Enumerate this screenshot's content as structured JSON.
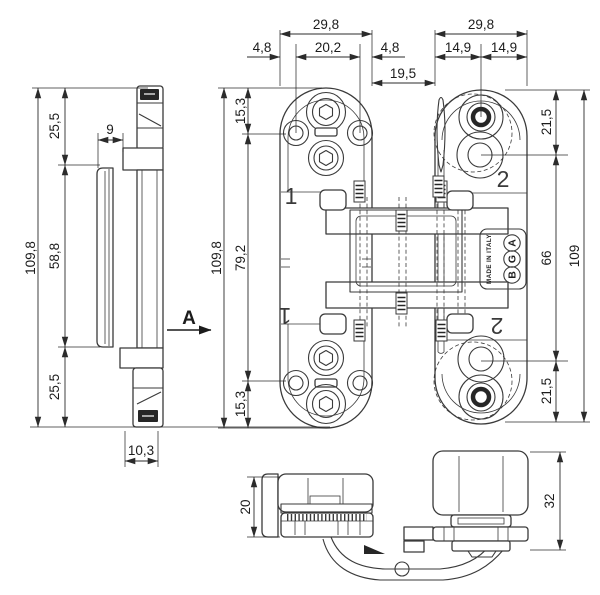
{
  "drawing": {
    "type": "technical-drawing",
    "subject": "concealed hinge dimensioned views",
    "colors": {
      "line": "#3a3a3a",
      "dimension": "#2b2b2b",
      "text": "#1c1c1c",
      "dark_fill": "#262626",
      "background": "#ffffff"
    },
    "section_label": "A",
    "parts": {
      "frame_part": "1",
      "door_part": "2"
    },
    "logo": {
      "letters": [
        "A",
        "G",
        "B"
      ],
      "made_in": "MADE IN ITALY"
    },
    "dimensions": {
      "side_view": {
        "top": "25,5",
        "offset": "9",
        "overall": "109,8",
        "middle": "58,8",
        "bottom": "25,5",
        "thickness": "10,3"
      },
      "frame_view": {
        "overall_width": "29,8",
        "edge_to_hole_left": "4,8",
        "hole_spacing": "20,2",
        "edge_to_hole_right": "4,8",
        "cap_top": "15,3",
        "hole_span": "79,2",
        "cap_bottom": "15,3",
        "overall_height": "109,8"
      },
      "gap": "19,5",
      "door_view": {
        "overall_width": "29,8",
        "half_left": "14,9",
        "half_right": "14,9",
        "top_hole": "21,5",
        "hole_span": "66",
        "bottom_hole": "21,5",
        "overall_height": "109"
      },
      "bottom_view": {
        "frame_height": "20",
        "door_height": "32"
      }
    }
  }
}
